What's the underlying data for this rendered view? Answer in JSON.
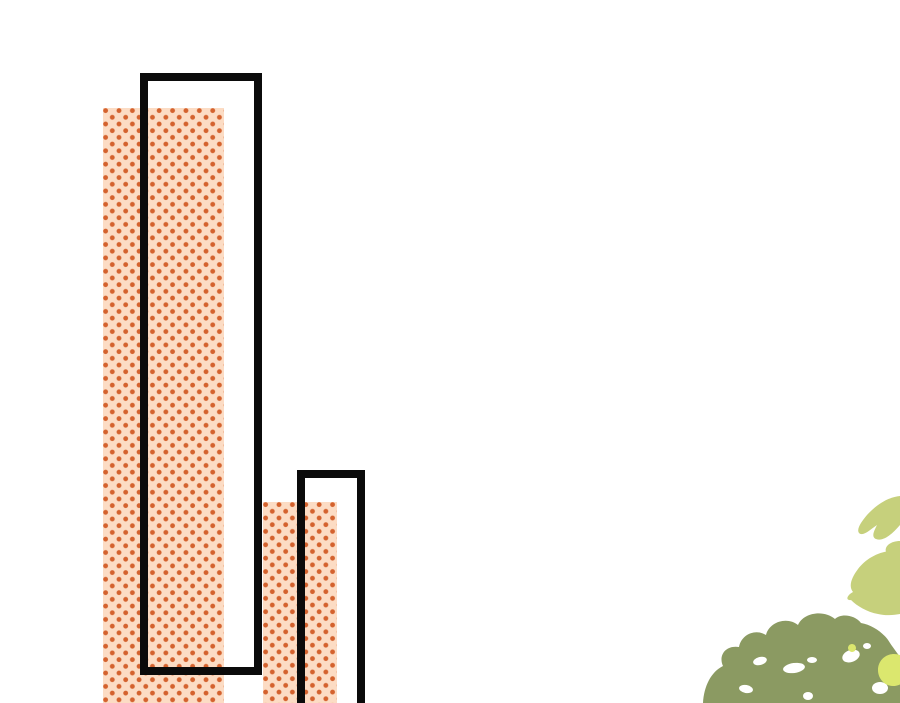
{
  "scene": {
    "description": "Comic background panel: two tall halftone-dotted building shapes, two black rectangle outlines, watercolor foliage in bottom-right corner",
    "canvas": {
      "width": 900,
      "height": 703
    },
    "colors": {
      "canvas-bg": "#ffffff",
      "halftone-bg": "#fcdcc4",
      "halftone-dot": "#d4622e",
      "outline": "#0b0b0b",
      "leaf-light": "#c6d07c",
      "leaf-olive": "#8b9a62",
      "leaf-yellow": "#dbe76e",
      "speckle": "#ffffff"
    },
    "shapes": {
      "halftone_bar_1": {
        "left": 103,
        "top": 108,
        "width": 121,
        "height": 595
      },
      "building_outline_1": {
        "left": 140,
        "top": 73,
        "width": 122,
        "height": 602,
        "border": 8
      },
      "halftone_bar_2": {
        "left": 263,
        "top": 502,
        "width": 74,
        "height": 201
      },
      "building_outline_2": {
        "left": 297,
        "top": 470,
        "width": 68,
        "height": 260,
        "border": 8
      }
    },
    "foliage": {
      "region": {
        "left": 660,
        "top": 470,
        "width": 240,
        "height": 233
      },
      "viewbox": "0 0 240 233",
      "light_leaf_upper_path": "M240 26 C229 27 217 34 207 45 C202 51 196 59 199 63 C203 67 211 59 217 55 C214 61 211 67 216 69 C224 72 233 63 240 55 Z",
      "light_leaf_bridge_path": "M240 71 C231 71 224 76 226 82 C228 88 235 90 240 89 Z",
      "light_leaf_lower_path": "M240 81 C223 79 207 87 198 99 C192 107 188 116 193 122 C187 125 185 131 191 130 C197 136 207 142 218 144 C226 146 234 145 240 144 Z",
      "bush_path": "M43 233 C44 216 51 202 63 196 C58 185 66 175 79 177 C81 165 95 158 106 165 C109 152 127 146 138 155 C143 143 163 139 175 149 C181 143 195 145 201 153 C213 155 225 164 230 173 C234 179 238 184 240 187 L240 233 Z",
      "yellow_blob_path": "M218 200 C218 191 225 184 234 184 C243 184 249 191 249 200 C249 209 242 216 233 216 C225 216 218 209 218 200 Z M188 178 C188 175.8 189.8 174 192 174 C194.2 174 196 175.8 196 178 C196 180.2 194.2 182 192 182 C190.2 182 188 180.2 188 178 Z",
      "speckles": [
        {
          "cx": 100,
          "cy": 191,
          "rx": 7,
          "ry": 4,
          "rot": -15
        },
        {
          "cx": 134,
          "cy": 198,
          "rx": 11,
          "ry": 5,
          "rot": -8
        },
        {
          "cx": 152,
          "cy": 190,
          "rx": 5,
          "ry": 3,
          "rot": 0
        },
        {
          "cx": 191,
          "cy": 186,
          "rx": 9,
          "ry": 6,
          "rot": -20
        },
        {
          "cx": 86,
          "cy": 219,
          "rx": 7,
          "ry": 4,
          "rot": 10
        },
        {
          "cx": 148,
          "cy": 226,
          "rx": 5,
          "ry": 4,
          "rot": 0
        },
        {
          "cx": 220,
          "cy": 218,
          "rx": 8,
          "ry": 6,
          "rot": 0
        },
        {
          "cx": 207,
          "cy": 176,
          "rx": 4,
          "ry": 3,
          "rot": 0
        }
      ]
    }
  }
}
